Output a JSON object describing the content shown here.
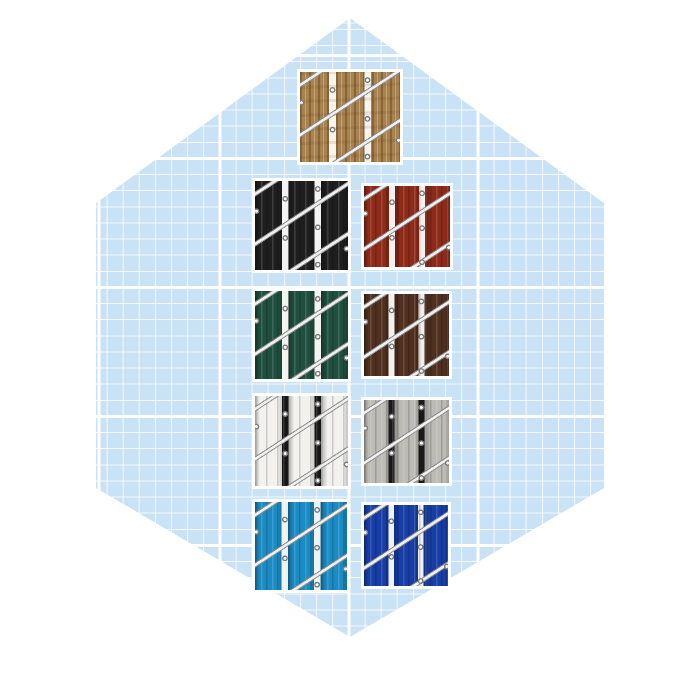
{
  "canvas": {
    "background_color": "#ffffff"
  },
  "hexagon": {
    "shape": "pointy-top-hexagon",
    "background_color": "#c9e2f5",
    "grid_line_color": "#ffffff",
    "grid_minor_spacing_px": 16,
    "grid_major_spacing_px": 129
  },
  "wire_color": "#f0f0f0",
  "swatches": [
    {
      "id": "beige-wood",
      "label": "beige wood privacy slats in chain-link fence",
      "slat_color": "#a8834f",
      "gap_color": "#f6f5f2",
      "row": 1,
      "column": "center"
    },
    {
      "id": "black",
      "label": "black privacy slats in chain-link fence",
      "slat_color": "#1e1e1e",
      "gap_color": "#f2f2f2",
      "row": 2,
      "column": "left"
    },
    {
      "id": "dark-red",
      "label": "dark red privacy slats in chain-link fence",
      "slat_color": "#8e2a18",
      "gap_color": "#f2f0ee",
      "row": 2,
      "column": "right"
    },
    {
      "id": "forest-green",
      "label": "forest green privacy slats in chain-link fence",
      "slat_color": "#1f4f3f",
      "gap_color": "#f2f2ef",
      "row": 3,
      "column": "left"
    },
    {
      "id": "brown",
      "label": "brown privacy slats in chain-link fence",
      "slat_color": "#4f2f1e",
      "gap_color": "#f1efec",
      "row": 3,
      "column": "right"
    },
    {
      "id": "white",
      "label": "white privacy slats in chain-link fence",
      "slat_color": "#f2f1ee",
      "gap_color": "#161616",
      "row": 4,
      "column": "left"
    },
    {
      "id": "gray",
      "label": "gray privacy slats in chain-link fence",
      "slat_color": "#bdbbb6",
      "gap_color": "#191919",
      "row": 4,
      "column": "right"
    },
    {
      "id": "sky-blue",
      "label": "sky blue privacy slats in chain-link fence",
      "slat_color": "#1b8bc4",
      "gap_color": "#eef2f4",
      "row": 5,
      "column": "left"
    },
    {
      "id": "royal-blue",
      "label": "royal blue privacy slats in chain-link fence",
      "slat_color": "#173da6",
      "gap_color": "#eef0f4",
      "row": 5,
      "column": "right"
    }
  ]
}
